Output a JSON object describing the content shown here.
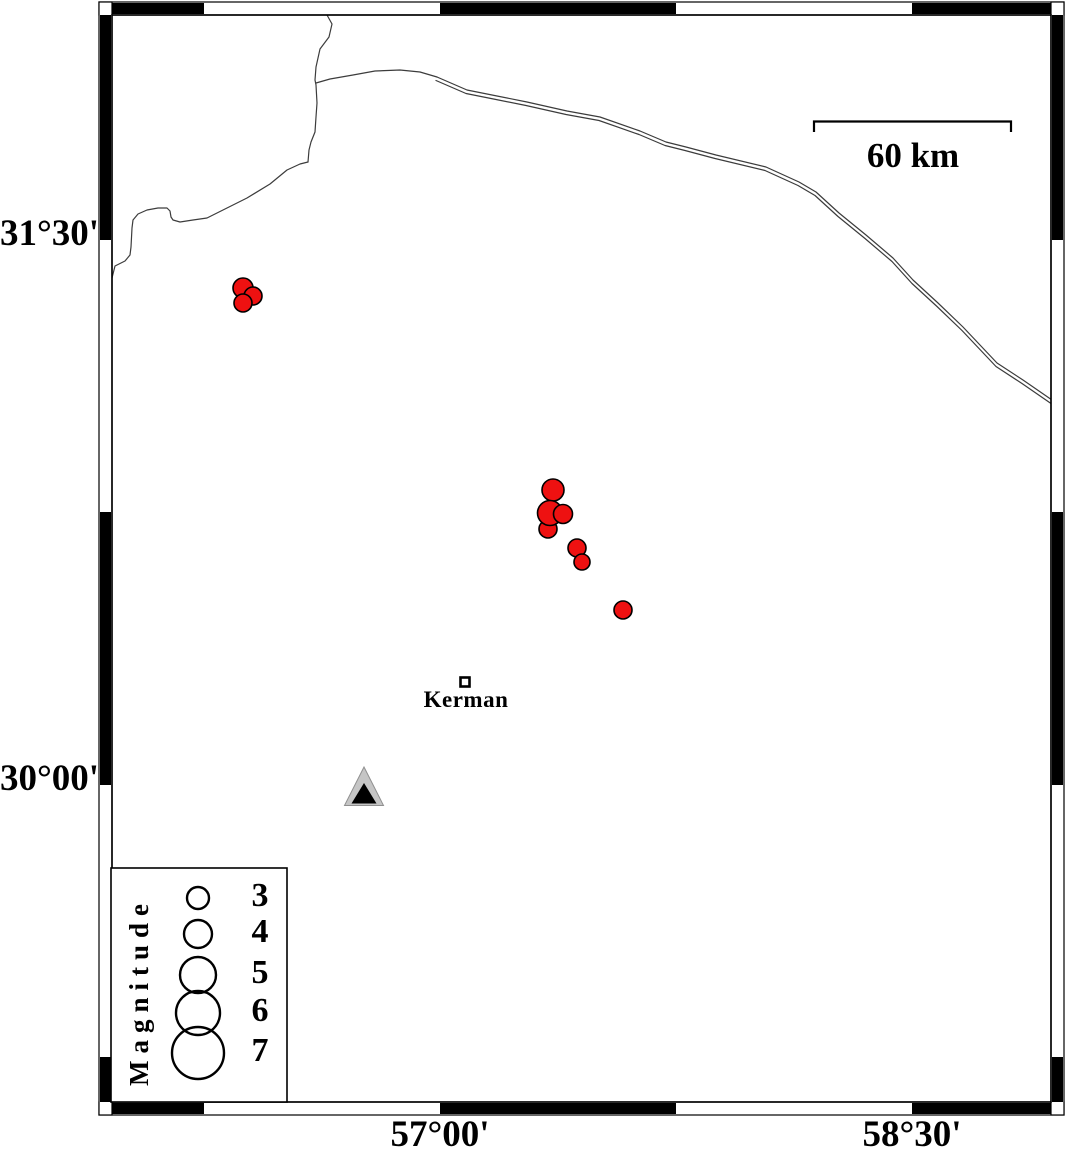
{
  "figure": {
    "title": "Kerman region seismicity map",
    "axis": {
      "left_labels": [
        {
          "text": "31°30'",
          "y": 240
        },
        {
          "text": "30°00'",
          "y": 785
        }
      ],
      "bottom_labels": [
        {
          "text": "57°00'",
          "x": 440
        },
        {
          "text": "58°30'",
          "x": 912
        }
      ]
    },
    "scale_bar": {
      "label": "60 km",
      "x1": 814,
      "x2": 1011,
      "y": 122
    },
    "city": {
      "name": "Kerman",
      "x": 465,
      "y": 682,
      "lon": 57.08,
      "lat": 30.28
    },
    "station": {
      "symbol": "triangle",
      "x": 364,
      "y": 793,
      "lon": 56.76,
      "lat": 29.98
    },
    "legend": {
      "title": "Magnitude",
      "items": [
        {
          "label": "3",
          "r": 11,
          "cy": 898
        },
        {
          "label": "4",
          "r": 14,
          "cy": 934
        },
        {
          "label": "5",
          "r": 18,
          "cy": 975
        },
        {
          "label": "6",
          "r": 22,
          "cy": 1013
        },
        {
          "label": "7",
          "r": 26,
          "cy": 1053
        }
      ]
    },
    "earthquakes": [
      {
        "x": 243,
        "y": 288,
        "r": 10,
        "lon": 56.37,
        "lat": 31.37
      },
      {
        "x": 253,
        "y": 296,
        "r": 9,
        "lon": 56.41,
        "lat": 31.35
      },
      {
        "x": 243,
        "y": 303,
        "r": 9,
        "lon": 56.37,
        "lat": 31.33
      },
      {
        "x": 553,
        "y": 490,
        "r": 11,
        "lon": 57.36,
        "lat": 30.81
      },
      {
        "x": 548,
        "y": 529,
        "r": 9,
        "lon": 57.34,
        "lat": 30.7
      },
      {
        "x": 550,
        "y": 513,
        "r": 12.5,
        "lon": 57.35,
        "lat": 30.75
      },
      {
        "x": 563,
        "y": 514,
        "r": 9.5,
        "lon": 57.39,
        "lat": 30.75
      },
      {
        "x": 577,
        "y": 548,
        "r": 9,
        "lon": 57.44,
        "lat": 30.65
      },
      {
        "x": 582,
        "y": 562,
        "r": 8,
        "lon": 57.45,
        "lat": 30.61
      },
      {
        "x": 623,
        "y": 610,
        "r": 9,
        "lon": 57.58,
        "lat": 30.48
      }
    ],
    "colors": {
      "epicenter": "#ee1111",
      "outline": "#000000",
      "station_fill": "#c5c5c5",
      "station_inner": "#000000",
      "line": "#3c3c3c"
    }
  }
}
